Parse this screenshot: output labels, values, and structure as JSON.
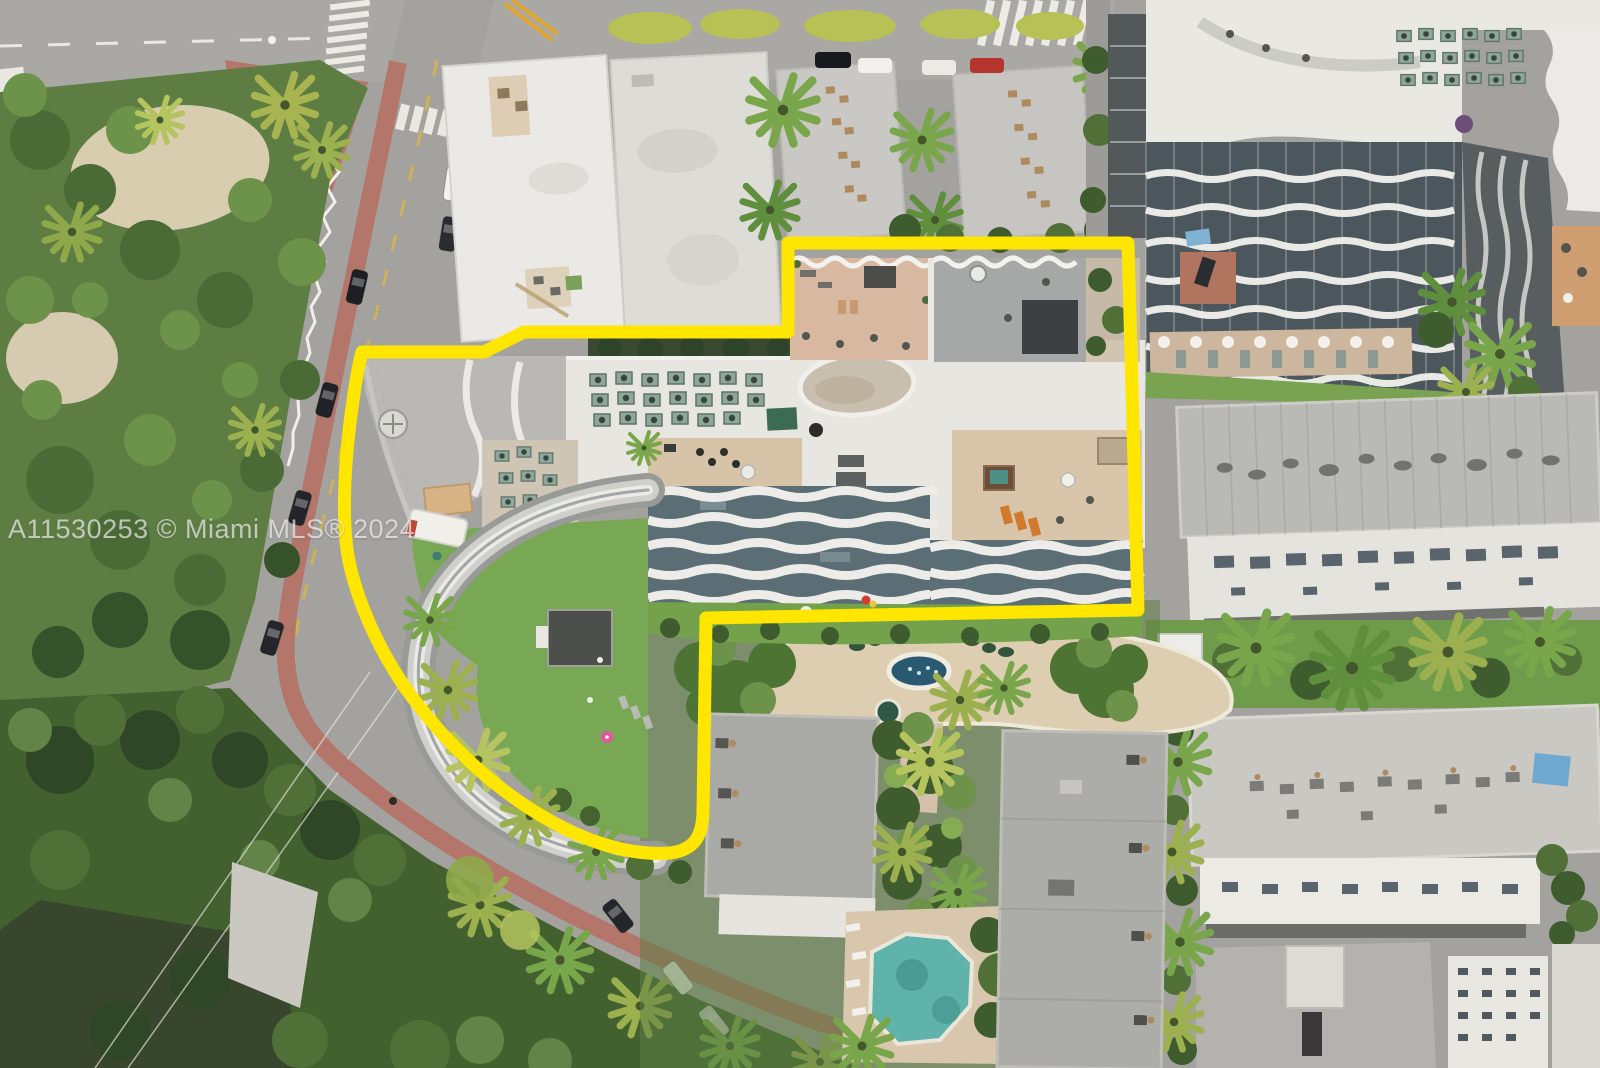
{
  "watermark": {
    "text": "A11530253 © Miami MLS® 2024"
  },
  "colors": {
    "property_outline": "#ffe600",
    "pool_water": "#5fb3aa",
    "fountain_water": "#2a5a72"
  }
}
